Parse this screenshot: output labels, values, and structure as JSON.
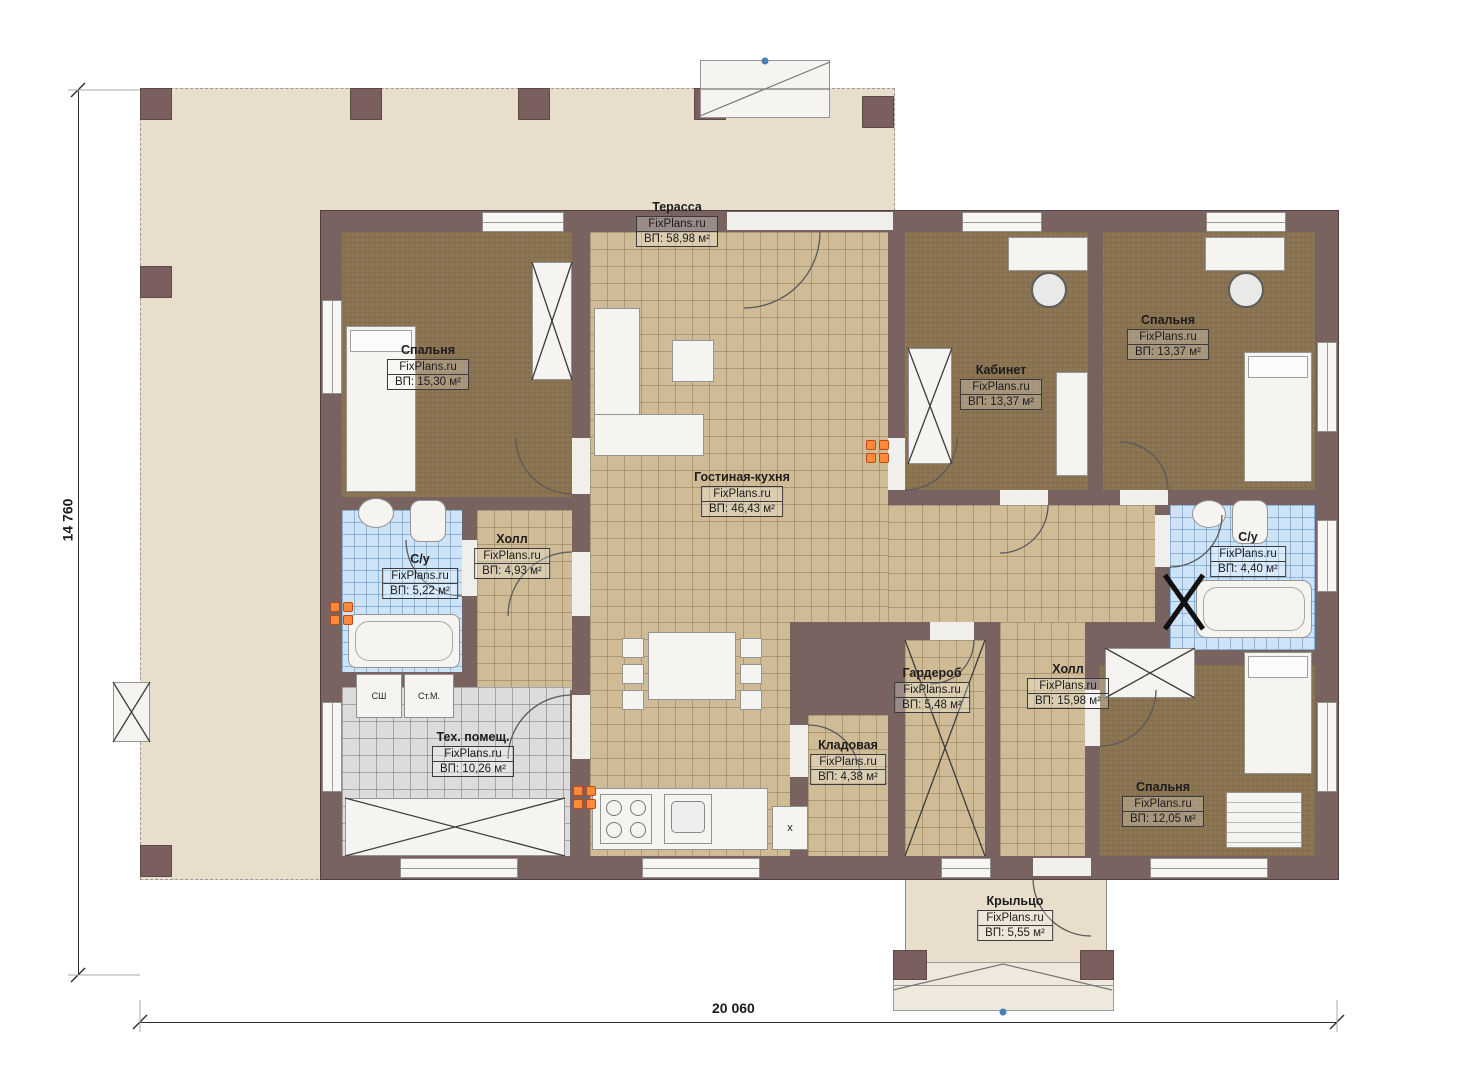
{
  "watermark": "FixPlans.ru",
  "dimensions": {
    "horizontal": "20 060",
    "vertical": "14 760"
  },
  "rooms": {
    "terrace": {
      "name": "Терасса",
      "area": "ВП: 58,98 м²"
    },
    "bedroom_tl": {
      "name": "Спальня",
      "area": "ВП: 15,30 м²"
    },
    "office": {
      "name": "Кабинет",
      "area": "ВП: 13,37 м²"
    },
    "bedroom_tr": {
      "name": "Спальня",
      "area": "ВП: 13,37 м²"
    },
    "living_kitchen": {
      "name": "Гостиная-кухня",
      "area": "ВП: 46,43 м²"
    },
    "bath_left": {
      "name": "С/у",
      "area": "ВП: 5,22 м²"
    },
    "hall_left": {
      "name": "Холл",
      "area": "ВП: 4,93 м²"
    },
    "bath_right": {
      "name": "С/у",
      "area": "ВП: 4,40 м²"
    },
    "wardrobe": {
      "name": "Гардероб",
      "area": "ВП: 5,48 м²"
    },
    "hall_right": {
      "name": "Холл",
      "area": "ВП: 15,98 м²"
    },
    "tech": {
      "name": "Тех. помещ.",
      "area": "ВП: 10,26 м²"
    },
    "pantry": {
      "name": "Кладовая",
      "area": "ВП: 4,38 м²"
    },
    "bedroom_br": {
      "name": "Спальня",
      "area": "ВП: 12,05 м²"
    },
    "porch": {
      "name": "Крыльцо",
      "area": "ВП: 5,55 м²"
    }
  },
  "appliance_labels": {
    "drying_cabinet": "СШ",
    "washing_machine": "Ст.М."
  },
  "markers": {
    "kitchen_unit": "x"
  }
}
